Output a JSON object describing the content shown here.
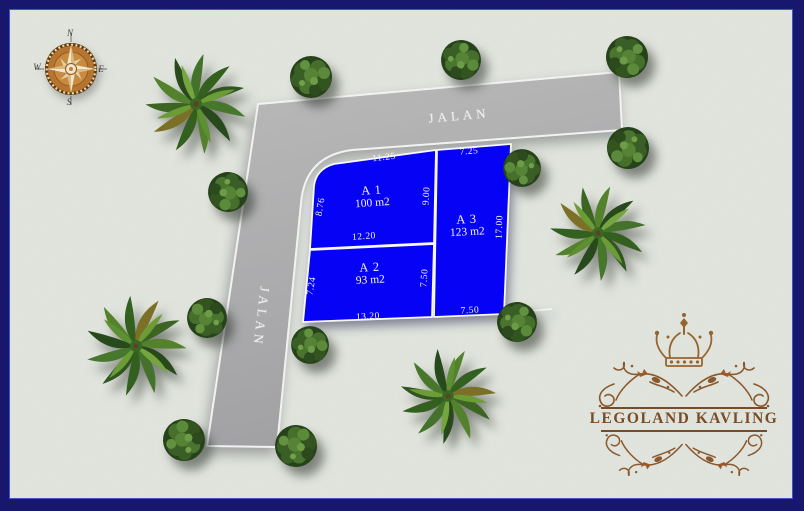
{
  "title": "Legoland Kavling site plan",
  "compass": {
    "north": "N",
    "east": "E",
    "south": "S",
    "west": "W"
  },
  "road": {
    "label_top": "JALAN",
    "label_left": "JALAN"
  },
  "plots": [
    {
      "name": "A 1",
      "area": "100 m2",
      "top": "11.25",
      "left": "8.76",
      "right": "9.00",
      "bottom": "12.20"
    },
    {
      "name": "A 2",
      "area": "93 m2",
      "left": "7.24",
      "right": "7.50",
      "bottom": "13.20"
    },
    {
      "name": "A 3",
      "area": "123 m2",
      "top": "7.25",
      "right": "17.00",
      "bottom": "7.50"
    }
  ],
  "logo": {
    "title": "LEGOLAND KAVLING"
  },
  "colors": {
    "plot_blue": "#0502f6",
    "road_gray": "#a9a9ab",
    "background": "#e2e6df",
    "border_navy": "#17176e",
    "logo_brown": "#7a4c26",
    "compass_copper": "#b5742f"
  }
}
